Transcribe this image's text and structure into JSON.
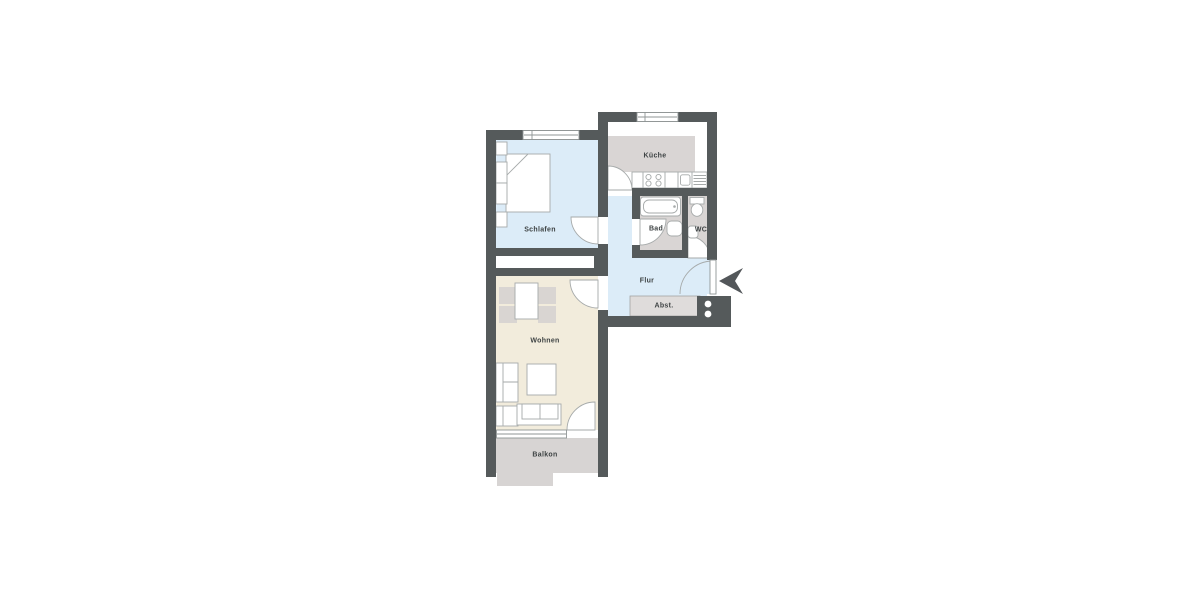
{
  "floorplan": {
    "rooms": {
      "schlafen": {
        "label": "Schlafen"
      },
      "kueche": {
        "label": "Küche"
      },
      "bad": {
        "label": "Bad"
      },
      "wc": {
        "label": "WC"
      },
      "flur": {
        "label": "Flur"
      },
      "abst": {
        "label": "Abst."
      },
      "wohnen": {
        "label": "Wohnen"
      },
      "balkon": {
        "label": "Balkon"
      }
    },
    "entrance": {
      "icon": "entrance-arrow",
      "direction": "left"
    },
    "colors": {
      "wall": "#555a5b",
      "floor_blue": "#dcecf8",
      "floor_beige": "#f2ecdc",
      "floor_grey": "#d9d5d4",
      "balcony_grey": "#d7d4d3",
      "storage_grey": "#dfdcdb",
      "outline": "#a6aaaa",
      "label_text": "#3d4243",
      "background": "#ffffff"
    }
  }
}
